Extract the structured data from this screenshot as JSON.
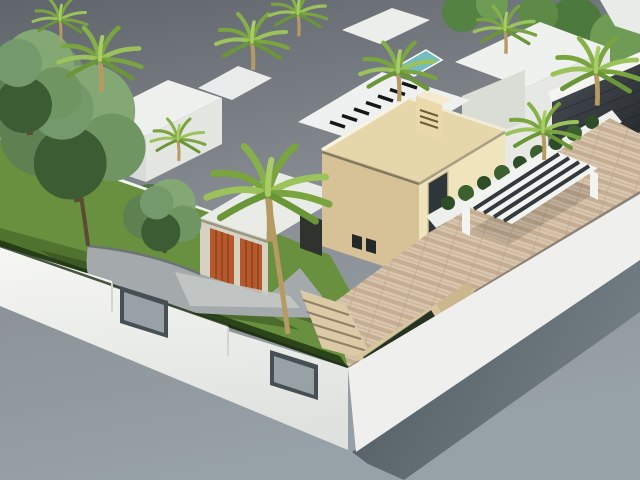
{
  "scene": {
    "type": "3d-architectural-rendering",
    "subject": "modern villa with garden, palms, terrace and neighbouring houses",
    "view": "aerial-isometric"
  },
  "colors": {
    "sky_top": "#5f656b",
    "sky_mid": "#8b9196",
    "sky_bottom": "#97a1a8",
    "band_dark_a": "#4d585f",
    "band_dark_b": "#737e85",
    "wall_white": "#f3f4f1",
    "wall_white_shade": "#dcdfda",
    "lawn": "#69903e",
    "lawn_dark": "#2c4419",
    "drive": "#a4aaab",
    "drive_light": "#c6c9c6",
    "terrace_base": "#d8c7ae",
    "terrace_stripe": "#c4ad92",
    "terrace_stripe2": "#cdb39b",
    "villa_stone": "#e6d7ab",
    "villa_stone_light": "#f0e4bd",
    "villa_stone_shade": "#d6c296",
    "roof_white": "#eef0ed",
    "garage_door": "#b5592d",
    "garage_door_dark": "#8a3c1d",
    "wood_panel": "#96552e",
    "glass_dark": "#2b3134",
    "water_dark": "#28331f",
    "trough_stone": "#d8c59c",
    "foliage": "#5d8150",
    "foliage_light": "#84a873",
    "foliage_dark": "#3c5c33",
    "palm_frond": "#79a43f",
    "palm_frond_light": "#9cc25b",
    "palm_trunk": "#b69a63",
    "stone_dark_a": "#4a5056",
    "stone_dark_b": "#24282c",
    "pool_teal": "#74bcc0",
    "pergola_white": "#f2f4f2",
    "pergola_slot": "#33393c",
    "shrub": "#2e4c27",
    "shrub_light": "#3d6031",
    "curb": "#6d7374",
    "tread": "#8f8067",
    "trunk_brown": "#5c4a33"
  }
}
